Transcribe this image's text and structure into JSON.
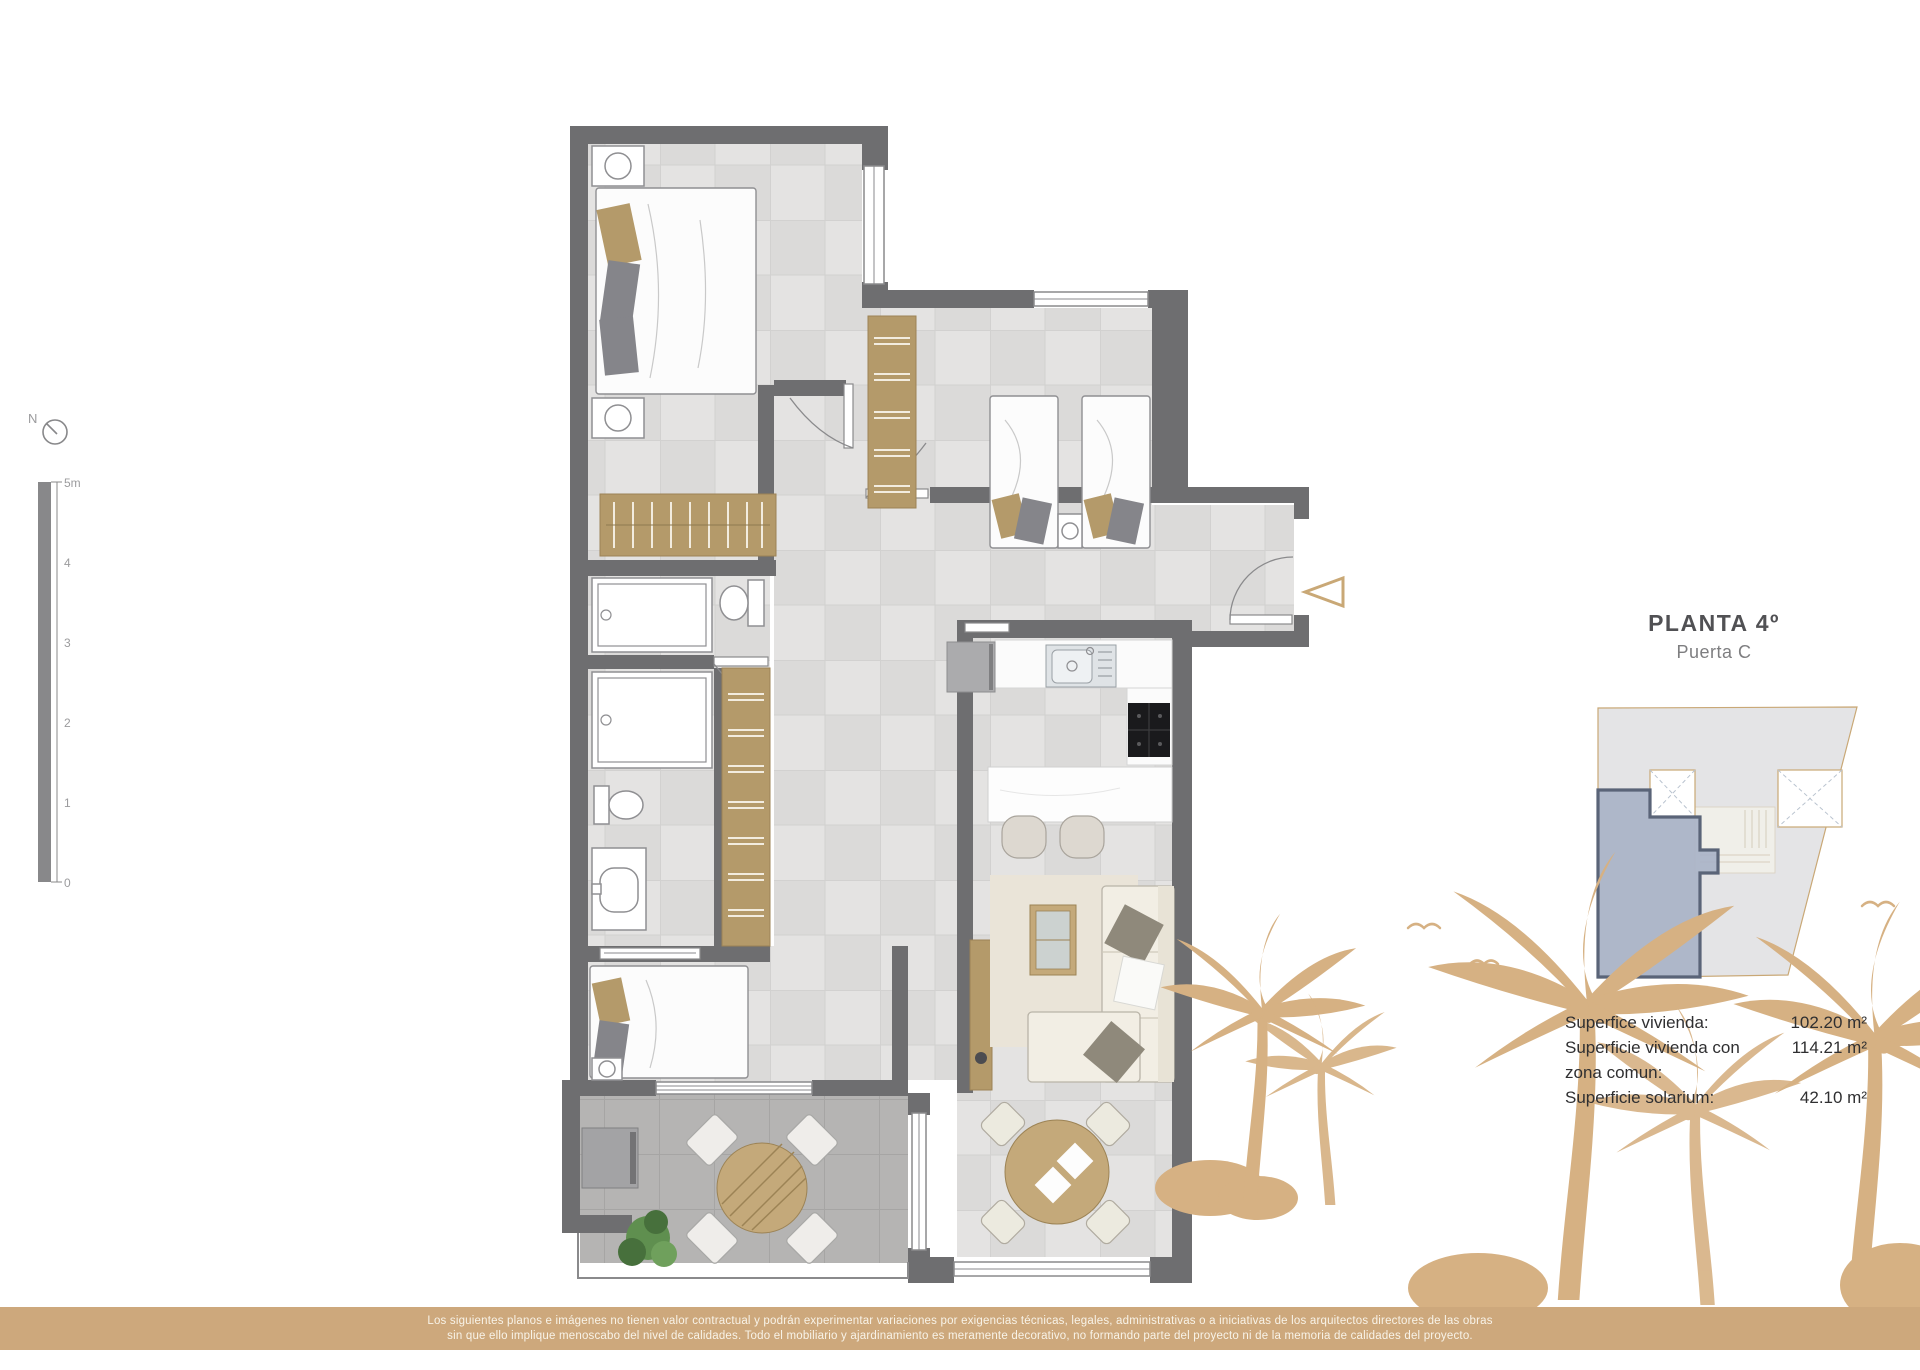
{
  "title": {
    "main": "PLANTA 4º",
    "sub": "Puerta C"
  },
  "compass": {
    "label": "N"
  },
  "scale_bar": {
    "ticks": [
      "5m",
      "4",
      "3",
      "2",
      "1",
      "0"
    ]
  },
  "areas": {
    "rows": [
      {
        "label": "Superfice vivienda:",
        "value": "102.20 m²"
      },
      {
        "label": "Superficie vivienda con",
        "value": "114.21 m²"
      },
      {
        "label": "zona comun:",
        "value": ""
      },
      {
        "label": "Superficie solarium:",
        "value": "42.10 m²"
      }
    ]
  },
  "disclaimer": {
    "line1": "Los siguientes planos e imágenes no tienen valor contractual y podrán experimentar variaciones por exigencias técnicas, legales, administrativas o a iniciativas de los arquitectos directores de las obras",
    "line2": "sin que ello implique menoscabo del nivel de calidades. Todo el mobiliario y ajardinamiento es meramente decorativo, no formando parte del proyecto ni de la memoria de calidades del proyecto."
  },
  "colors": {
    "wall": "#6e6e70",
    "floor": "#e4e3e2",
    "floor_alt": "#dbdad9",
    "floor_line": "#d2d1d0",
    "terrace": "#b5b4b3",
    "terrace_line": "#a6a5a4",
    "window_stroke": "#8a8a8c",
    "arc": "#8a8a8c",
    "fixture_stroke": "#8f8f92",
    "wood": "#c4a97a",
    "wood_dark": "#9c8355",
    "wardrobe": "#b49a6a",
    "wardrobe_line": "#f2ecdf",
    "bed_white": "#fcfcfc",
    "tan_pillow": "#b49a6a",
    "gray_pillow": "#85858a",
    "sofa": "#f2eee4",
    "sofa_back": "#e8e3d6",
    "sofa_stroke": "#b9b4a8",
    "pillow": "#8f897b",
    "rug": "#eae4d8",
    "stool": "#ddd8d0",
    "metal": "#ababad",
    "dark_appliance": "#1a1a1c",
    "plant": "#5f8f4f",
    "plant_dark": "#47703c",
    "accent_tan": "#c9a876",
    "palm": "#d6b183",
    "band": "#cda87c",
    "band_text": "#f8f3e8",
    "text_dark": "#2f2f31",
    "title_color": "#515154",
    "subtitle_color": "#7e7e80",
    "keyplan_fill": "#e4e4e6",
    "keyplan_stairs": "#f0efe9",
    "keyplan_unit": "#a9b3c7",
    "keyplan_unit_border": "#5a6478",
    "scalebar": "#88888a",
    "scalebar_text": "#9b9b9d"
  }
}
